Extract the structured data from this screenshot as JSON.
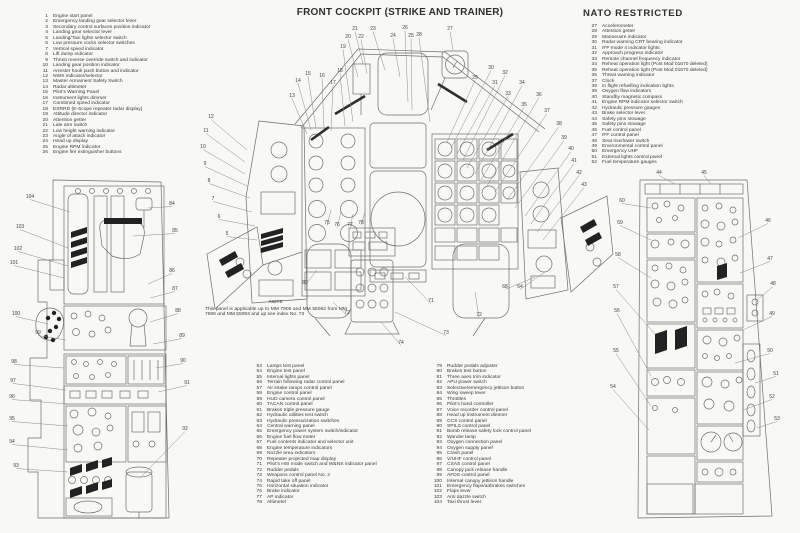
{
  "page": {
    "title": "FRONT COCKPIT (STRIKE AND TRAINER)",
    "classification": "NATO RESTRICTED",
    "note_heading": "NOTE",
    "note_text": "This panel is applicable up to MM 7905 and MM 55062 from MM 7906 and MM 55063 and up see index No. 73"
  },
  "colors": {
    "ink": "#3a3a3a",
    "line": "#6e6e6e",
    "dark": "#2e2e2e"
  },
  "legend": {
    "col1": [
      {
        "n": "1",
        "label": "Engine start panel"
      },
      {
        "n": "2",
        "label": "Emergency landing gear selector lever"
      },
      {
        "n": "3",
        "label": "Secondary control surfaces position indicator"
      },
      {
        "n": "4",
        "label": "Landing gear selector lever"
      },
      {
        "n": "5",
        "label": "Landing/Taxi lights selector switch"
      },
      {
        "n": "6",
        "label": "Low pressure cocks selector switches"
      },
      {
        "n": "7",
        "label": "Vertical speed indicator"
      },
      {
        "n": "8",
        "label": "Lift dump indicator"
      },
      {
        "n": "9",
        "label": "Thrust reverse override switch and indicator"
      },
      {
        "n": "10",
        "label": "Landing gear position indicator"
      },
      {
        "n": "11",
        "label": "Arrester hook push button and indicator"
      },
      {
        "n": "12",
        "label": "NWS indicator/selector"
      },
      {
        "n": "13",
        "label": "Master Armament Safety Switch"
      },
      {
        "n": "14",
        "label": "Radar altimeter"
      },
      {
        "n": "15",
        "label": "Pilot's Warning Panel"
      },
      {
        "n": "16",
        "label": "Instrument lights dimmer"
      },
      {
        "n": "17",
        "label": "Combined speed indicator"
      },
      {
        "n": "18",
        "label": "ESRRD (E-Scope repeater radar display)"
      },
      {
        "n": "19",
        "label": "Attitude director indicator"
      },
      {
        "n": "20",
        "label": "Attention getter"
      },
      {
        "n": "21",
        "label": "Late arm switch"
      },
      {
        "n": "22",
        "label": "Low height warning indicator"
      },
      {
        "n": "23",
        "label": "Angle of attack indicator"
      },
      {
        "n": "24",
        "label": "Head up display"
      },
      {
        "n": "25",
        "label": "Engine RPM indicator"
      },
      {
        "n": "26",
        "label": "Engine fire extinguisher buttons"
      }
    ],
    "col2": [
      {
        "n": "27",
        "label": "Accelerometer"
      },
      {
        "n": "28",
        "label": "Attention getter"
      },
      {
        "n": "29",
        "label": "Manoeuvre indicator"
      },
      {
        "n": "30",
        "label": "Radar warning CRT bearing indicator"
      },
      {
        "n": "31",
        "label": "IFF mode 4 indicator lights"
      },
      {
        "n": "32",
        "label": "Approach progress indicator"
      },
      {
        "n": "33",
        "label": "Remote channel frequency indicator"
      },
      {
        "n": "34",
        "label": "Reheat operation light (Post Mod 01670 deleted)"
      },
      {
        "n": "35",
        "label": "Reheat operation light (Post Mod 01670 deleted)"
      },
      {
        "n": "36",
        "label": "Threat warning indicator"
      },
      {
        "n": "37",
        "label": "Clock"
      },
      {
        "n": "38",
        "label": "In flight refuelling indication lights"
      },
      {
        "n": "39",
        "label": "Oxygen flow indicators"
      },
      {
        "n": "40",
        "label": "Standby magnetic compass"
      },
      {
        "n": "41",
        "label": "Engine RPM indicator selector switch"
      },
      {
        "n": "42",
        "label": "Hydraulic pressure gauges"
      },
      {
        "n": "43",
        "label": "Brake selector lever"
      },
      {
        "n": "44",
        "label": "Safety pins stowage"
      },
      {
        "n": "45",
        "label": "Safety pins stowage"
      },
      {
        "n": "46",
        "label": "Fuel control panel"
      },
      {
        "n": "47",
        "label": "IFF control panel"
      },
      {
        "n": "48",
        "label": "Seat rise/lower switch"
      },
      {
        "n": "49",
        "label": "Environmental control panel"
      },
      {
        "n": "50",
        "label": "Emergency UHF"
      },
      {
        "n": "51",
        "label": "External lights control panel"
      },
      {
        "n": "52",
        "label": "Fuel temperature gauges"
      }
    ],
    "col3": [
      {
        "n": "53",
        "label": "Lamps test panel"
      },
      {
        "n": "54",
        "label": "Engine test panel"
      },
      {
        "n": "55",
        "label": "Internal lights panel"
      },
      {
        "n": "56",
        "label": "Terrain following radar control panel"
      },
      {
        "n": "57",
        "label": "Air intake ramps control panel"
      },
      {
        "n": "58",
        "label": "Engine control panel"
      },
      {
        "n": "59",
        "label": "HUD camera control panel"
      },
      {
        "n": "60",
        "label": "TACAN control panel"
      },
      {
        "n": "61",
        "label": "Brakes triple pressure gauge"
      },
      {
        "n": "62",
        "label": "Hydraulic utilities test switch"
      },
      {
        "n": "63",
        "label": "Hydraulic pressurization switches"
      },
      {
        "n": "64",
        "label": "Central warning panel"
      },
      {
        "n": "65",
        "label": "Emergency power system switch/indicator"
      },
      {
        "n": "66",
        "label": "Engine fuel flow meter"
      },
      {
        "n": "67",
        "label": "Fuel contents indicator and selector unit"
      },
      {
        "n": "68",
        "label": "Engine temperature indicators"
      },
      {
        "n": "69",
        "label": "Nozzle area indicators"
      },
      {
        "n": "70",
        "label": "Repeater projected map display"
      },
      {
        "n": "71",
        "label": "Pilot's HSI mode switch and W&NS indicator panel"
      },
      {
        "n": "72",
        "label": "Rudder pedals"
      },
      {
        "n": "73",
        "label": "Weapons control panel No. 2"
      },
      {
        "n": "74",
        "label": "Rapid take off panel"
      },
      {
        "n": "75",
        "label": "Horizontal situation indicator"
      },
      {
        "n": "76",
        "label": "Brake indicator"
      },
      {
        "n": "77",
        "label": "AP indicator"
      },
      {
        "n": "78",
        "label": "Altimeter"
      }
    ],
    "col4": [
      {
        "n": "79",
        "label": "Rudder pedals adjuster"
      },
      {
        "n": "80",
        "label": "Brakes test button"
      },
      {
        "n": "81",
        "label": "Three axes trim indicator"
      },
      {
        "n": "82",
        "label": "APU power switch"
      },
      {
        "n": "83",
        "label": "Selective/emergency jettison button"
      },
      {
        "n": "84",
        "label": "Wing sweep lever"
      },
      {
        "n": "85",
        "label": "Throttles"
      },
      {
        "n": "86",
        "label": "Pilot's hand controller"
      },
      {
        "n": "87",
        "label": "Voice recorder control panel"
      },
      {
        "n": "88",
        "label": "Head up instrument dimmer"
      },
      {
        "n": "89",
        "label": "CCS control panel"
      },
      {
        "n": "90",
        "label": "SPILS control panel"
      },
      {
        "n": "91",
        "label": "Bomb release safety lock control panel"
      },
      {
        "n": "92",
        "label": "Wander lamp"
      },
      {
        "n": "93",
        "label": "Oxygen connection panel"
      },
      {
        "n": "94",
        "label": "Oxygen supply panel"
      },
      {
        "n": "95",
        "label": "Crash panel"
      },
      {
        "n": "96",
        "label": "V/UHF control panel"
      },
      {
        "n": "97",
        "label": "CSAS control panel"
      },
      {
        "n": "98",
        "label": "Canopy jack release handle"
      },
      {
        "n": "99",
        "label": "AFDS control panel"
      },
      {
        "n": "100",
        "label": "Internal canopy jettison handle"
      },
      {
        "n": "101",
        "label": "Emergency flaps/airbrakes switches"
      },
      {
        "n": "102",
        "label": "Flaps lever"
      },
      {
        "n": "103",
        "label": "Anti dazzle switch"
      },
      {
        "n": "104",
        "label": "Taxi thrust lever"
      }
    ]
  },
  "diagram": {
    "center": {
      "callouts": [
        {
          "n": "21",
          "x": 160,
          "y": 8,
          "tx": 168,
          "ty": 42
        },
        {
          "n": "20",
          "x": 153,
          "y": 16,
          "tx": 163,
          "ty": 55
        },
        {
          "n": "22",
          "x": 166,
          "y": 16,
          "tx": 172,
          "ty": 52
        },
        {
          "n": "23",
          "x": 178,
          "y": 8,
          "tx": 190,
          "ty": 48
        },
        {
          "n": "19",
          "x": 148,
          "y": 26,
          "tx": 158,
          "ty": 100
        },
        {
          "n": "24",
          "x": 198,
          "y": 15,
          "tx": 205,
          "ty": 55
        },
        {
          "n": "26",
          "x": 210,
          "y": 7,
          "tx": 213,
          "ty": 80
        },
        {
          "n": "25",
          "x": 216,
          "y": 15,
          "tx": 217,
          "ty": 88
        },
        {
          "n": "27",
          "x": 255,
          "y": 8,
          "tx": 258,
          "ty": 28
        },
        {
          "n": "28",
          "x": 224,
          "y": 14,
          "tx": 235,
          "ty": 100
        },
        {
          "n": "29",
          "x": 280,
          "y": 57,
          "tx": 252,
          "ty": 120
        },
        {
          "n": "30",
          "x": 296,
          "y": 47,
          "tx": 256,
          "ty": 126
        },
        {
          "n": "31",
          "x": 300,
          "y": 62,
          "tx": 262,
          "ty": 132
        },
        {
          "n": "32",
          "x": 310,
          "y": 52,
          "tx": 268,
          "ty": 138
        },
        {
          "n": "33",
          "x": 313,
          "y": 73,
          "tx": 272,
          "ty": 146
        },
        {
          "n": "34",
          "x": 327,
          "y": 62,
          "tx": 280,
          "ty": 152
        },
        {
          "n": "35",
          "x": 329,
          "y": 84,
          "tx": 286,
          "ty": 158
        },
        {
          "n": "36",
          "x": 344,
          "y": 74,
          "tx": 292,
          "ty": 164
        },
        {
          "n": "37",
          "x": 352,
          "y": 90,
          "tx": 300,
          "ty": 170
        },
        {
          "n": "38",
          "x": 364,
          "y": 103,
          "tx": 312,
          "ty": 178
        },
        {
          "n": "39",
          "x": 369,
          "y": 117,
          "tx": 320,
          "ty": 186
        },
        {
          "n": "40",
          "x": 376,
          "y": 128,
          "tx": 330,
          "ty": 194
        },
        {
          "n": "41",
          "x": 379,
          "y": 140,
          "tx": 336,
          "ty": 202
        },
        {
          "n": "42",
          "x": 384,
          "y": 152,
          "tx": 342,
          "ty": 210
        },
        {
          "n": "43",
          "x": 389,
          "y": 164,
          "tx": 348,
          "ty": 218
        },
        {
          "n": "13",
          "x": 97,
          "y": 75,
          "tx": 112,
          "ty": 112
        },
        {
          "n": "14",
          "x": 103,
          "y": 60,
          "tx": 116,
          "ty": 108
        },
        {
          "n": "15",
          "x": 113,
          "y": 53,
          "tx": 121,
          "ty": 106
        },
        {
          "n": "16",
          "x": 127,
          "y": 55,
          "tx": 129,
          "ty": 107
        },
        {
          "n": "17",
          "x": 138,
          "y": 62,
          "tx": 136,
          "ty": 109
        },
        {
          "n": "18",
          "x": 145,
          "y": 50,
          "tx": 150,
          "ty": 104
        },
        {
          "n": "12",
          "x": 16,
          "y": 96,
          "tx": 52,
          "ty": 128
        },
        {
          "n": "11",
          "x": 11,
          "y": 110,
          "tx": 50,
          "ty": 140
        },
        {
          "n": "10",
          "x": 8,
          "y": 126,
          "tx": 50,
          "ty": 152
        },
        {
          "n": "9",
          "x": 10,
          "y": 143,
          "tx": 52,
          "ty": 164
        },
        {
          "n": "8",
          "x": 14,
          "y": 160,
          "tx": 55,
          "ty": 176
        },
        {
          "n": "7",
          "x": 18,
          "y": 178,
          "tx": 57,
          "ty": 190
        },
        {
          "n": "6",
          "x": 24,
          "y": 196,
          "tx": 60,
          "ty": 204
        },
        {
          "n": "5",
          "x": 32,
          "y": 213,
          "tx": 62,
          "ty": 218
        },
        {
          "n": "75",
          "x": 132,
          "y": 202,
          "tx": 136,
          "ty": 188
        },
        {
          "n": "76",
          "x": 142,
          "y": 204,
          "tx": 146,
          "ty": 190
        },
        {
          "n": "77",
          "x": 155,
          "y": 204,
          "tx": 158,
          "ty": 192
        },
        {
          "n": "78",
          "x": 166,
          "y": 202,
          "tx": 170,
          "ty": 190
        },
        {
          "n": "80",
          "x": 110,
          "y": 262,
          "tx": 122,
          "ty": 248
        },
        {
          "n": "71",
          "x": 236,
          "y": 280,
          "tx": 210,
          "ty": 255
        },
        {
          "n": "72",
          "x": 152,
          "y": 292,
          "tx": 138,
          "ty": 280
        },
        {
          "n": "72",
          "x": 284,
          "y": 294,
          "tx": 280,
          "ty": 270
        },
        {
          "n": "73",
          "x": 251,
          "y": 312,
          "tx": 200,
          "ty": 290
        },
        {
          "n": "74",
          "x": 206,
          "y": 322,
          "tx": 186,
          "ty": 300
        },
        {
          "n": "64",
          "x": 325,
          "y": 266,
          "tx": 350,
          "ty": 250
        },
        {
          "n": "68",
          "x": 310,
          "y": 266,
          "tx": 340,
          "ty": 255
        }
      ]
    },
    "left_console": {
      "callouts": [
        {
          "n": "104",
          "x": 22,
          "y": 26,
          "tx": 62,
          "ty": 40
        },
        {
          "n": "103",
          "x": 12,
          "y": 56,
          "tx": 60,
          "ty": 76
        },
        {
          "n": "102",
          "x": 10,
          "y": 78,
          "tx": 60,
          "ty": 94
        },
        {
          "n": "101",
          "x": 6,
          "y": 92,
          "tx": 56,
          "ty": 106
        },
        {
          "n": "100",
          "x": 8,
          "y": 143,
          "tx": 40,
          "ty": 152
        },
        {
          "n": "99",
          "x": 30,
          "y": 162,
          "tx": 58,
          "ty": 168
        },
        {
          "n": "98",
          "x": 6,
          "y": 191,
          "tx": 56,
          "ty": 196
        },
        {
          "n": "97",
          "x": 5,
          "y": 210,
          "tx": 58,
          "ty": 218
        },
        {
          "n": "96",
          "x": 4,
          "y": 226,
          "tx": 60,
          "ty": 232
        },
        {
          "n": "95",
          "x": 4,
          "y": 248,
          "tx": 60,
          "ty": 254
        },
        {
          "n": "94",
          "x": 4,
          "y": 271,
          "tx": 60,
          "ty": 278
        },
        {
          "n": "93",
          "x": 8,
          "y": 295,
          "tx": 60,
          "ty": 300
        },
        {
          "n": "84",
          "x": 164,
          "y": 33,
          "tx": 140,
          "ty": 36
        },
        {
          "n": "85",
          "x": 167,
          "y": 60,
          "tx": 125,
          "ty": 64
        },
        {
          "n": "86",
          "x": 164,
          "y": 100,
          "tx": 140,
          "ty": 112
        },
        {
          "n": "87",
          "x": 167,
          "y": 118,
          "tx": 142,
          "ty": 126
        },
        {
          "n": "88",
          "x": 170,
          "y": 140,
          "tx": 142,
          "ty": 150
        },
        {
          "n": "89",
          "x": 174,
          "y": 165,
          "tx": 145,
          "ty": 172
        },
        {
          "n": "90",
          "x": 175,
          "y": 190,
          "tx": 148,
          "ty": 196
        },
        {
          "n": "91",
          "x": 179,
          "y": 212,
          "tx": 150,
          "ty": 220
        },
        {
          "n": "92",
          "x": 177,
          "y": 258,
          "tx": 133,
          "ty": 305
        }
      ]
    },
    "right_console": {
      "callouts": [
        {
          "n": "44",
          "x": 54,
          "y": 6,
          "tx": 70,
          "ty": 16
        },
        {
          "n": "45",
          "x": 99,
          "y": 6,
          "tx": 106,
          "ty": 16
        },
        {
          "n": "46",
          "x": 163,
          "y": 54,
          "tx": 133,
          "ty": 70
        },
        {
          "n": "47",
          "x": 165,
          "y": 92,
          "tx": 135,
          "ty": 105
        },
        {
          "n": "48",
          "x": 168,
          "y": 117,
          "tx": 152,
          "ty": 132
        },
        {
          "n": "49",
          "x": 167,
          "y": 147,
          "tx": 138,
          "ty": 162
        },
        {
          "n": "50",
          "x": 165,
          "y": 184,
          "tx": 130,
          "ty": 195
        },
        {
          "n": "51",
          "x": 171,
          "y": 207,
          "tx": 150,
          "ty": 215
        },
        {
          "n": "52",
          "x": 167,
          "y": 230,
          "tx": 138,
          "ty": 242
        },
        {
          "n": "53",
          "x": 172,
          "y": 252,
          "tx": 152,
          "ty": 260
        },
        {
          "n": "60",
          "x": 17,
          "y": 34,
          "tx": 46,
          "ty": 40
        },
        {
          "n": "59",
          "x": 15,
          "y": 56,
          "tx": 46,
          "ty": 72
        },
        {
          "n": "58",
          "x": 13,
          "y": 88,
          "tx": 46,
          "ty": 110
        },
        {
          "n": "57",
          "x": 11,
          "y": 120,
          "tx": 50,
          "ty": 166
        },
        {
          "n": "56",
          "x": 12,
          "y": 144,
          "tx": 46,
          "ty": 208
        },
        {
          "n": "55",
          "x": 11,
          "y": 184,
          "tx": 46,
          "ty": 238
        },
        {
          "n": "54",
          "x": 8,
          "y": 220,
          "tx": 44,
          "ty": 262
        }
      ]
    }
  }
}
